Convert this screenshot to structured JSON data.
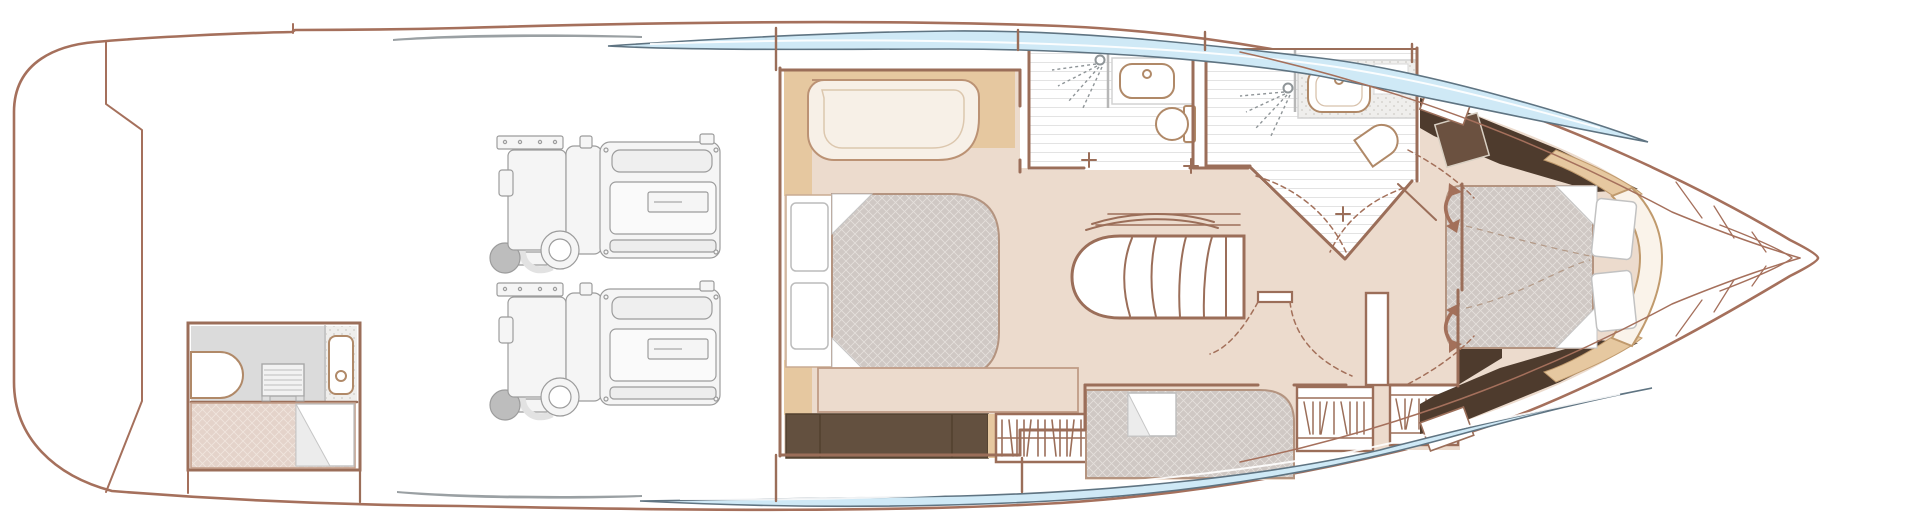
{
  "meta": {
    "width": 1920,
    "height": 532,
    "view": "lower-deck-floor-plan",
    "orientation": "bow-right"
  },
  "colors": {
    "hull": "#a5705c",
    "wall": "#9b6e59",
    "floor": "#ecdbcd",
    "accentWood": "#e6c8a0",
    "espresso": "#63503f",
    "espressoDark": "#4e3b2d",
    "espressoPanel": "#6b5140",
    "mattress": "#cfc8c4",
    "quiltLine": "#e4dfdb",
    "crewBerth": "#e4d3ca",
    "crewQuiltLine": "#f0e5dd",
    "windowGlass": "#cfe9f6",
    "windowEdge": "#5f7482",
    "tileLine": "#e3e3e3",
    "grayFloor": "#dbdbdb",
    "fixture": "#b08968",
    "glass": "#b7b7b7",
    "engineLine": "#9c9c9c",
    "engineFill": "#f5f5f5",
    "muffler": "#bdbdbd",
    "arrow": "#a3705a",
    "sliver": "#9aa0a3",
    "sofa": "#f7f0e7",
    "headboardIvory": "#faf3ea"
  },
  "plan": {
    "rooms": [
      "swim-platform-garage",
      "crew-cabin",
      "engine-room",
      "master-cabin",
      "master-bathroom",
      "companionway-stairs",
      "day-head-bathroom",
      "guest-cabin",
      "forward-vip-cabin",
      "bow-structure"
    ],
    "counts": {
      "engines": 2,
      "stair_treads": 5,
      "window_strips": 2,
      "shower_heads": 2,
      "sinks": 3,
      "toilets": 3,
      "beds": 4,
      "hanging_lockers": 3,
      "swing_arrows": 2
    }
  }
}
